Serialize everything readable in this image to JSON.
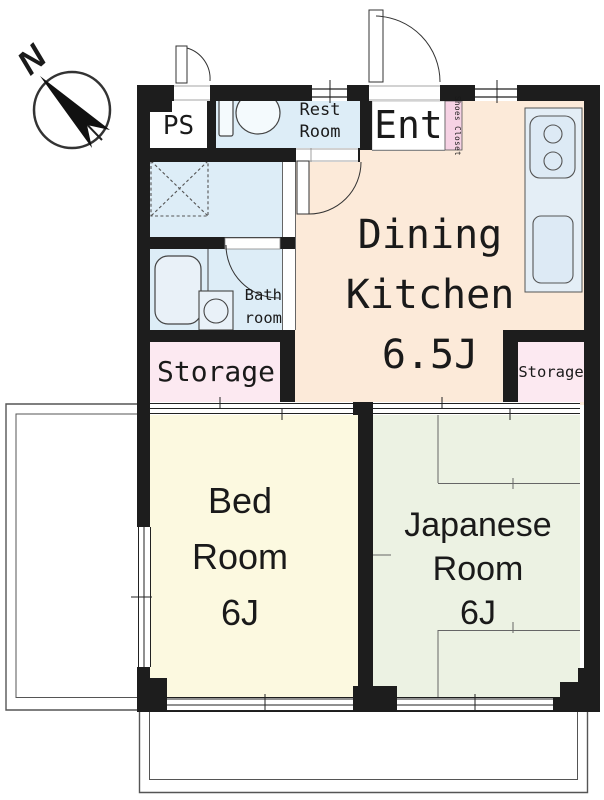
{
  "compass": {
    "north_label": "N"
  },
  "rooms": {
    "ps": {
      "label": "PS"
    },
    "rest_room": {
      "label_line1": "Rest",
      "label_line2": "Room"
    },
    "entrance": {
      "label": "Ent"
    },
    "shoes_closet": {
      "label": "Shoes Closet"
    },
    "dining_kitchen": {
      "label_line1": "Dining",
      "label_line2": "Kitchen",
      "size": "6.5J"
    },
    "bath_room": {
      "label_line1": "Bath",
      "label_line2": "room"
    },
    "storage_left": {
      "label": "Storage"
    },
    "storage_right": {
      "label": "Storage"
    },
    "bed_room": {
      "label_line1": "Bed",
      "label_line2": "Room",
      "size": "6J"
    },
    "japanese_room": {
      "label_line1": "Japanese",
      "label_line2": "Room",
      "size": "6J"
    }
  },
  "colors": {
    "wall": "#1d1d1d",
    "dining": "#fcead9",
    "wet": "#ddedf7",
    "counter": "#e4eef6",
    "storage": "#fce9f1",
    "shoes": "#f6d2e4",
    "bed": "#fcf9e0",
    "japanese": "#ecf2e3",
    "line": "#333333"
  }
}
